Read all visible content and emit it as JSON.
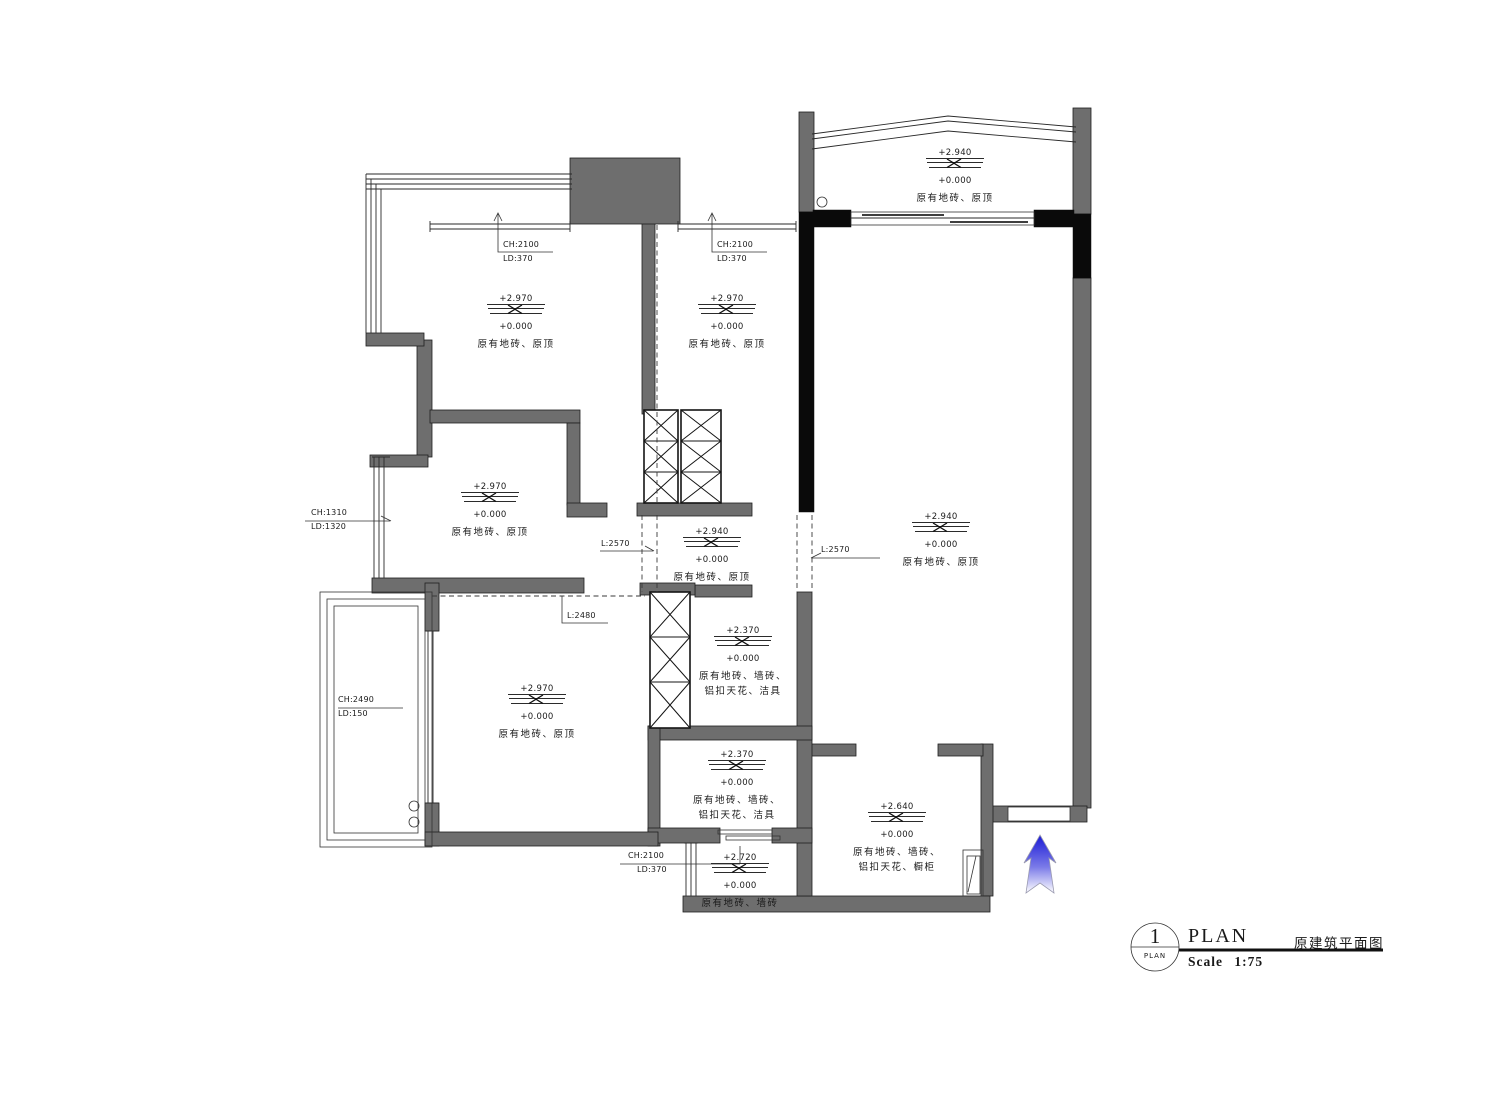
{
  "colors": {
    "wall_gray": "#6e6e6e",
    "wall_black": "#0a0a0a",
    "arrow_blue": "#1b1bd6"
  },
  "title_block": {
    "detail_number": "1",
    "detail_circle_caption": "PLAN",
    "drawing_title": "PLAN",
    "drawing_title_cn": "原建筑平面图",
    "scale_label": "Scale 1:75"
  },
  "rooms": {
    "top_balcony": {
      "upper": "+2.940",
      "lower": "+0.000",
      "desc1": "原有地砖、原顶"
    },
    "bedroom_left": {
      "upper": "+2.970",
      "lower": "+0.000",
      "desc1": "原有地砖、原顶"
    },
    "bedroom_mid": {
      "upper": "+2.970",
      "lower": "+0.000",
      "desc1": "原有地砖、原顶"
    },
    "room_mid_left": {
      "upper": "+2.970",
      "lower": "+0.000",
      "desc1": "原有地砖、原顶"
    },
    "hallway": {
      "upper": "+2.940",
      "lower": "+0.000",
      "desc1": "原有地砖、原顶"
    },
    "living_room": {
      "upper": "+2.940",
      "lower": "+0.000",
      "desc1": "原有地砖、原顶"
    },
    "bathroom_upper": {
      "upper": "+2.370",
      "lower": "+0.000",
      "desc1": "原有地砖、墙砖、",
      "desc2": "铝扣天花、洁具"
    },
    "room_lower_left": {
      "upper": "+2.970",
      "lower": "+0.000",
      "desc1": "原有地砖、原顶"
    },
    "bathroom_lower": {
      "upper": "+2.370",
      "lower": "+0.000",
      "desc1": "原有地砖、墙砖、",
      "desc2": "铝扣天花、洁具"
    },
    "kitchen": {
      "upper": "+2.640",
      "lower": "+0.000",
      "desc1": "原有地砖、墙砖、",
      "desc2": "铝扣天花、橱柜"
    },
    "utility": {
      "upper": "+2.720",
      "lower": "+0.000",
      "desc1": "原有地砖、墙砖"
    }
  },
  "window_tags": {
    "bedroom_left": {
      "l1": "CH:2100",
      "l2": "LD:370"
    },
    "bedroom_mid": {
      "l1": "CH:2100",
      "l2": "LD:370"
    },
    "mid_left": {
      "l1": "CH:1310",
      "l2": "LD:1320"
    },
    "balcony_left": {
      "l1": "CH:2490",
      "l2": "LD:150"
    },
    "utility": {
      "l1": "CH:2100",
      "l2": "LD:370"
    }
  },
  "opening_tags": {
    "hall_left": "L:2570",
    "hall_right": "L:2570",
    "lower_left": "L:2480"
  }
}
